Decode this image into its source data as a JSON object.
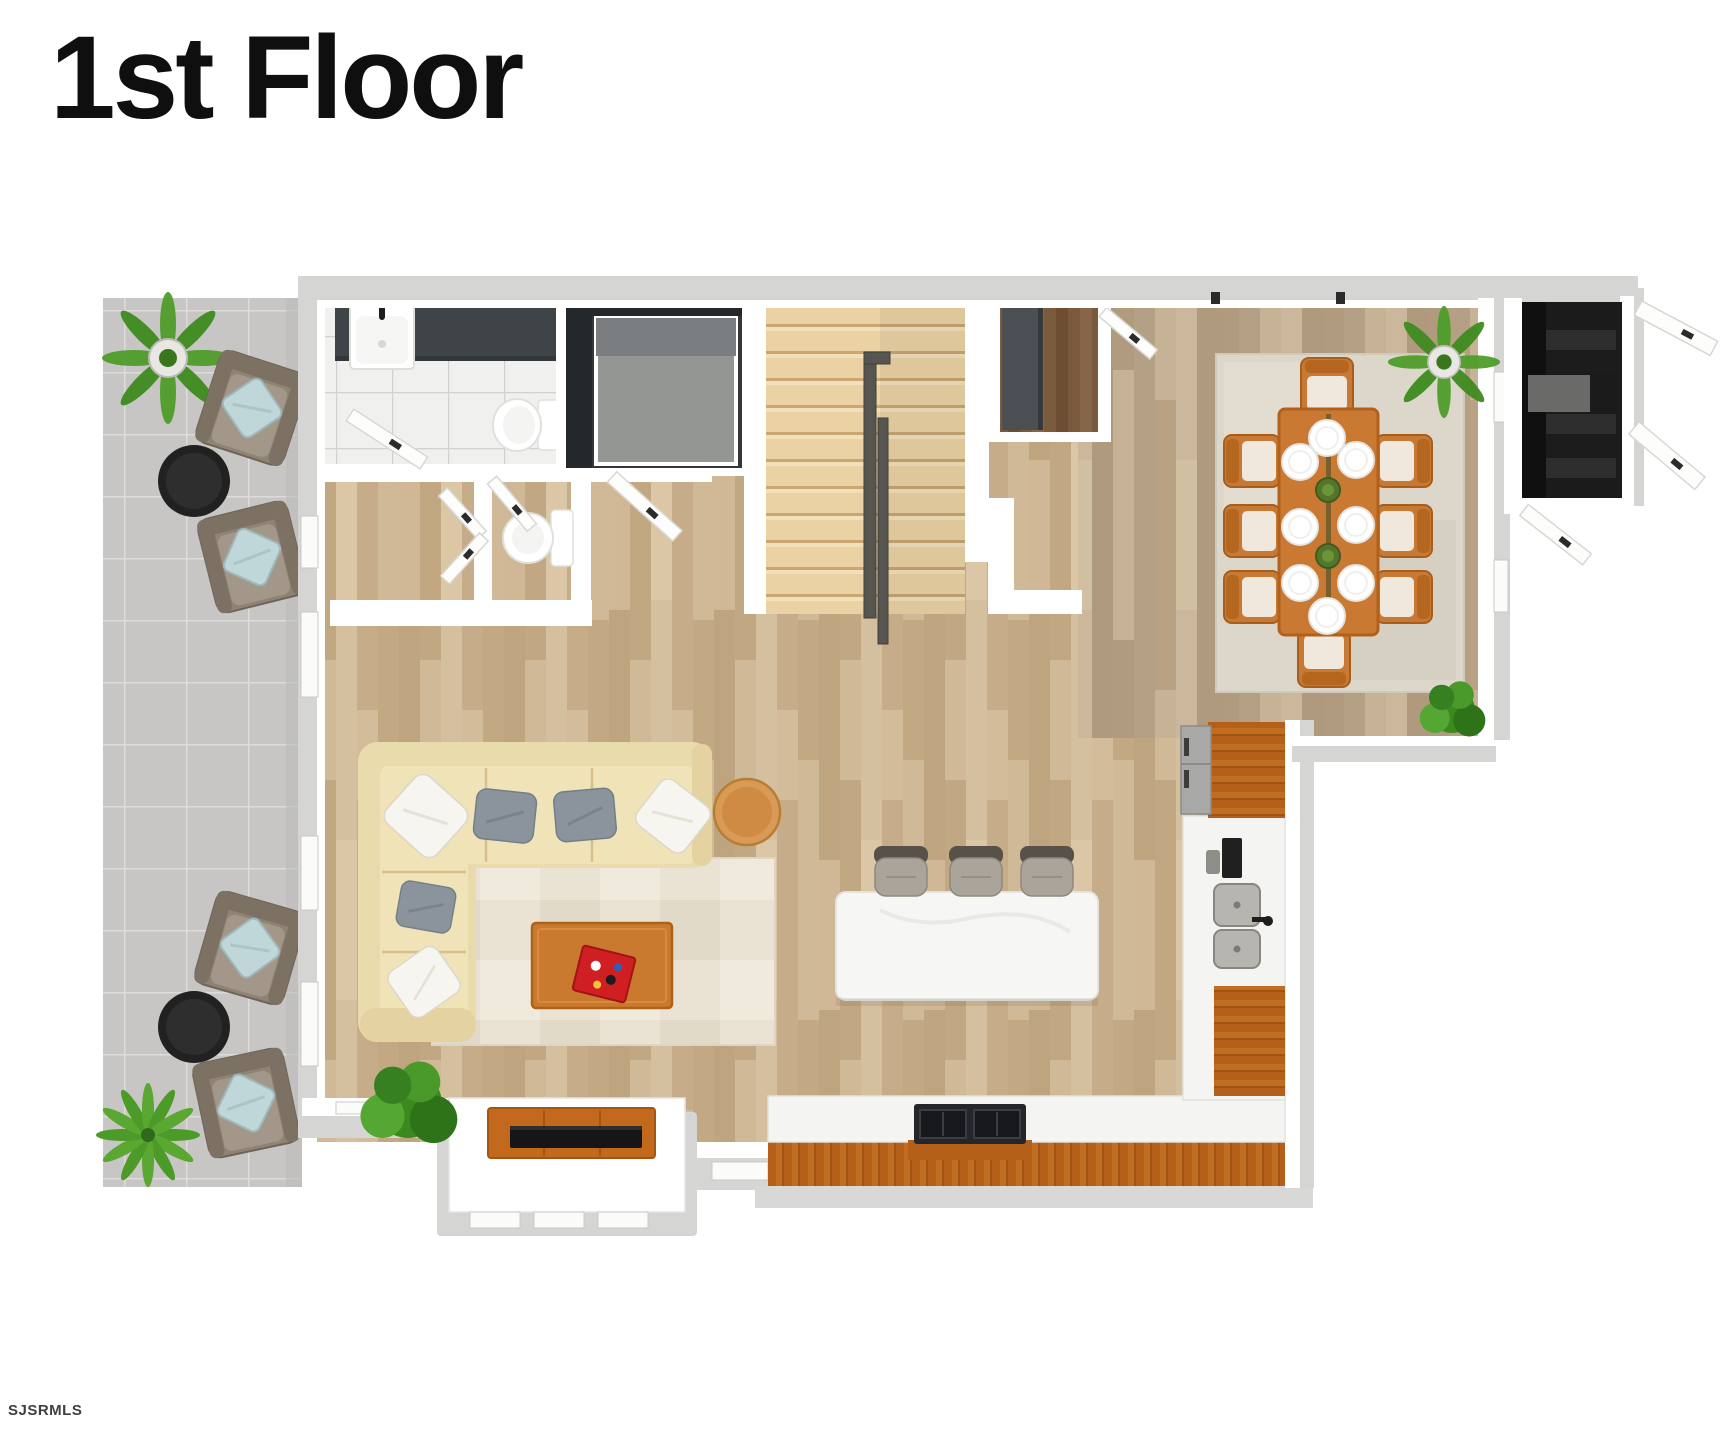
{
  "page": {
    "background_color": "#ffffff",
    "width": 1728,
    "height": 1440
  },
  "header": {
    "title": "1st Floor"
  },
  "footer": {
    "watermark": "SJSRMLS"
  },
  "palette": {
    "wall_gray": "#d5d5d3",
    "wall_white": "#ffffff",
    "wood_floor_main": "#cbb392",
    "wood_floor_dining": "#c2ae91",
    "stair_wood": "#ead2a4",
    "stair_rail": "#57554f",
    "patio_tile": "#c7c6c4",
    "bath_tile": "#f0f0ef",
    "shower_dark": "#33373a",
    "vanity_dark": "#3f4449",
    "sofa_beige": "#eadbad",
    "pillow_gray": "#8b949c",
    "pillow_white": "#f7f5f0",
    "living_rug": "#eae3d4",
    "dining_rug": "#dcd7ca",
    "coffee_table_wood": "#c9792e",
    "side_table_wood": "#d99a55",
    "tv_console_wood": "#c2691e",
    "tv_black": "#161616",
    "island_marble": "#f5f5f3",
    "counter_cabinet_wood": "#c06d22",
    "stool_gray": "#aba49b",
    "dining_table_wood": "#c97932",
    "chair_cushion": "#f1e8dd",
    "patio_chair": "#8f8374",
    "patio_pillow": "#c0d7da",
    "patio_table_black": "#212121",
    "plant_green": "#54a733",
    "entry_dark": "#1b1b1b",
    "tray_red": "#d01f23",
    "fridge_gray": "#a8a8a6"
  },
  "scene": {
    "floor_name": "1st Floor",
    "rooms": [
      "patio",
      "bathroom",
      "shower",
      "closet",
      "powder-room",
      "staircase",
      "hall-closet",
      "dining-room",
      "entry-vestibule",
      "kitchen",
      "living-room"
    ],
    "furniture_counts": {
      "patio_armchairs": 4,
      "patio_round_tables": 2,
      "patio_plants": 2,
      "dining_chairs": 8,
      "dinner_plates": 8,
      "dining_centerpieces": 2,
      "dining_plants": 2,
      "bar_stools": 3,
      "sofa_pillows": 6,
      "living_room_plants": 1,
      "door_leaves": 9,
      "sinks": 3,
      "toilets": 2,
      "televisions": 1
    }
  }
}
